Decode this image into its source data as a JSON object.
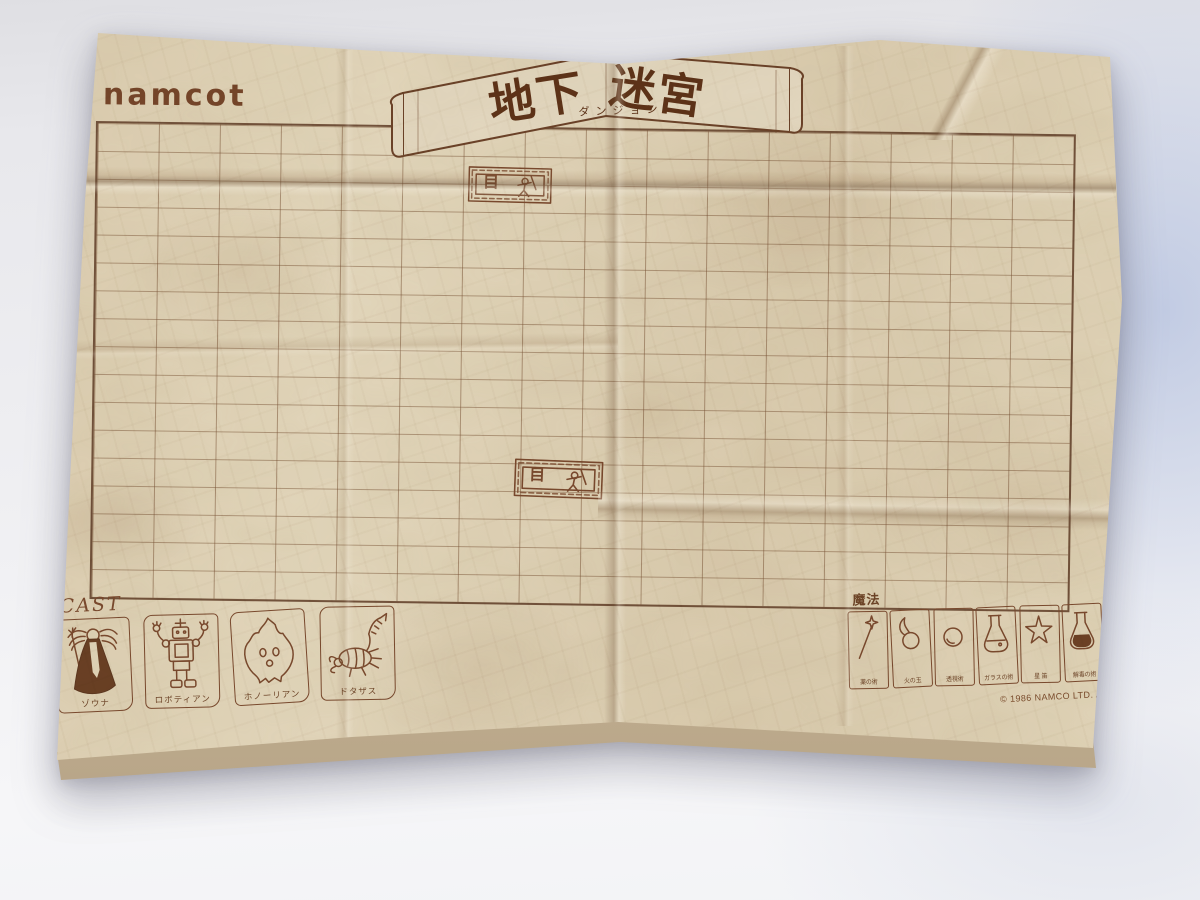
{
  "logo": {
    "text": "namcot"
  },
  "banner": {
    "title": "地下迷宮",
    "title_left": "地下",
    "title_right": "迷宮",
    "furigana": "ダンジョン"
  },
  "grid": {
    "columns": 16,
    "rows": 17
  },
  "entrance_marker": {
    "door_glyph": "目"
  },
  "cast": {
    "heading": "CAST",
    "members": [
      {
        "name": "ゾウナ",
        "icon": "wizard-figure"
      },
      {
        "name": "ロボティアン",
        "icon": "robot-figure"
      },
      {
        "name": "ホノーリアン",
        "icon": "flame-creature-figure"
      },
      {
        "name": "ドタザス",
        "icon": "scorpion-figure"
      }
    ]
  },
  "magic": {
    "heading": "魔法",
    "spells": [
      {
        "label": "薬の術",
        "icon": "wand-icon"
      },
      {
        "label": "火の玉",
        "icon": "fireball-icon"
      },
      {
        "label": "透視術",
        "icon": "sphere-icon"
      },
      {
        "label": "ガラスの術",
        "icon": "flask-icon"
      },
      {
        "label": "星 笛",
        "icon": "star-icon"
      },
      {
        "label": "解毒の術",
        "icon": "filled-flask-icon"
      },
      {
        "label": "いなずまの術",
        "icon": "lightning-icon"
      }
    ]
  },
  "footer": {
    "copyright": "© 1986 NAMCO LTD. ALL RIGHTS RESERVED"
  },
  "colors": {
    "paper": "#e0d4b8",
    "ink_brown": "#6e4528",
    "title_brown": "#5e3318",
    "grid_line": "rgba(120,82,52,0.5)",
    "backdrop_gray": "#ededf0",
    "backdrop_blue": "#b7c3e0"
  }
}
